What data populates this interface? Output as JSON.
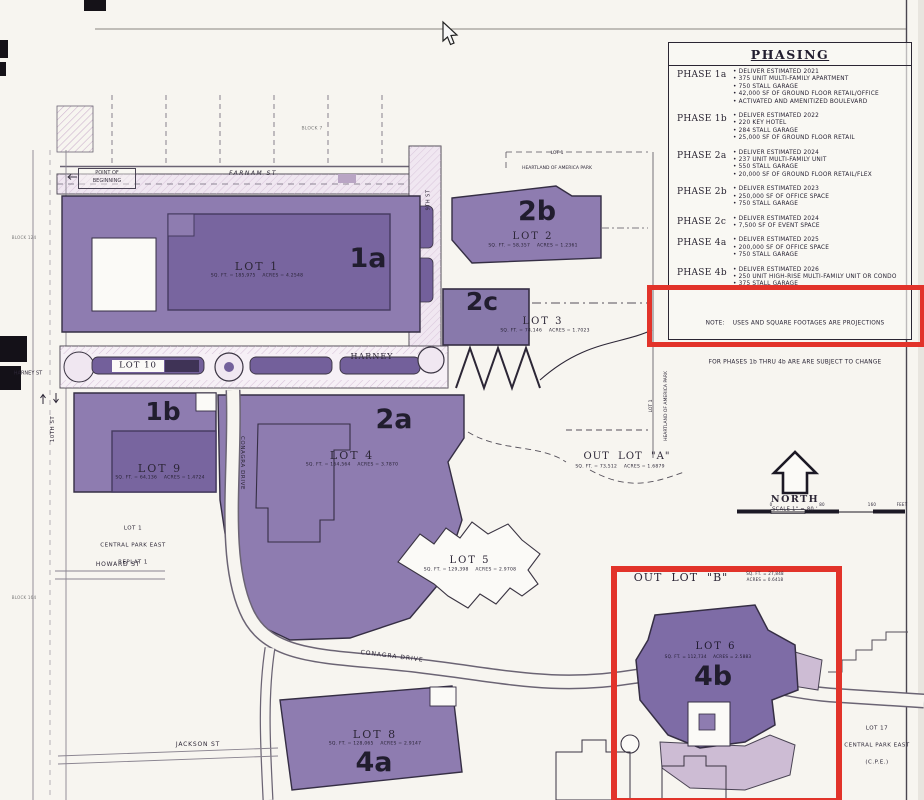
{
  "phasing": {
    "title": "PHASING",
    "rows": [
      {
        "phase": "PHASE 1a",
        "items": [
          "DELIVER ESTIMATED 2021",
          "375 UNIT MULTI-FAMILY APARTMENT",
          "750 STALL GARAGE",
          "42,000 SF OF GROUND FLOOR RETAIL/OFFICE",
          "ACTIVATED AND AMENITIZED BOULEVARD"
        ]
      },
      {
        "phase": "PHASE 1b",
        "items": [
          "DELIVER ESTIMATED 2022",
          "220 KEY HOTEL",
          "284 STALL GARAGE",
          "25,000 SF OF GROUND FLOOR RETAIL"
        ]
      },
      {
        "phase": "PHASE 2a",
        "items": [
          "DELIVER ESTIMATED 2024",
          "237 UNIT MULTI-FAMILY UNIT",
          "550 STALL GARAGE",
          "20,000 SF OF GROUND FLOOR RETAIL/FLEX"
        ]
      },
      {
        "phase": "PHASE 2b",
        "items": [
          "DELIVER ESTIMATED 2023",
          "250,000 SF OF OFFICE SPACE",
          "750 STALL GARAGE"
        ]
      },
      {
        "phase": "PHASE 2c",
        "items": [
          "DELIVER ESTIMATED 2024",
          "7,500 SF OF EVENT SPACE"
        ]
      },
      {
        "phase": "PHASE 4a",
        "items": [
          "DELIVER ESTIMATED 2025",
          "200,000 SF OF OFFICE SPACE",
          "750 STALL GARAGE"
        ]
      },
      {
        "phase": "PHASE 4b",
        "items": [
          "DELIVER ESTIMATED 2026",
          "250 UNIT HIGH-RISE MULTI-FAMILY UNIT OR CONDO",
          "375 STALL GARAGE"
        ]
      }
    ],
    "note_line1": "NOTE:    USES AND SQUARE FOOTAGES ARE PROJECTIONS",
    "note_line2": "FOR PHASES 1b THRU 4b ARE ARE SUBJECT TO CHANGE"
  },
  "compass": {
    "north": "NORTH",
    "scale": "SCALE 1\" = 80 '",
    "bar_labels": {
      "b0": "0",
      "b80": "80",
      "b160": "160",
      "bfeet": "FEET"
    }
  },
  "lots": {
    "lot1": {
      "name": "LOT 1",
      "stats": "SQ. FT. = 185,975    ACRES = 4.2548",
      "phase": "1a"
    },
    "lot2": {
      "name": "LOT 2",
      "stats": "SQ. FT. = 58,357    ACRES = 1.2361",
      "phase": "2b"
    },
    "lot3": {
      "name": "LOT 3",
      "stats": "SQ. FT. = 74,146    ACRES = 1.7023",
      "phase": "2c"
    },
    "lot4": {
      "name": "LOT 4",
      "stats": "SQ. FT. = 164,564    ACRES = 3.7870",
      "phase": "2a"
    },
    "lot5": {
      "name": "LOT 5",
      "stats": "SQ. FT. = 129,398    ACRES = 2.9708"
    },
    "lot6": {
      "name": "LOT 6",
      "stats": "SQ. FT. = 112,734    ACRES = 2.5883",
      "phase": "4b"
    },
    "lot8": {
      "name": "LOT 8",
      "stats": "SQ. FT. = 128,065    ACRES = 2.9147",
      "phase": "4a"
    },
    "lot9": {
      "name": "LOT 9",
      "stats": "SQ. FT. = 64,136    ACRES = 1.4724",
      "phase": "1b"
    },
    "lot10": {
      "name": "LOT 10"
    },
    "outlot_a": {
      "name": "OUT  LOT  \"A\"",
      "stats": "SQ. FT. = 73,512    ACRES = 1.6879"
    },
    "outlot_b": {
      "name": "OUT  LOT  \"B\"",
      "stats_line1": "SQ. FT. = 27,848",
      "stats_line2": "ACRES = 0.6418"
    }
  },
  "streets": {
    "farnam": "FARNAM ST",
    "harney": "HARNEY",
    "harney_left": "HARNEY ST",
    "howard": "HOWARD ST",
    "jackson": "JACKSON ST",
    "conagra_curve": "CONAGRA DRIVE",
    "conagra_vert": "CONAGRA DRIVE",
    "tenth": "10TH ST",
    "ninth": "9TH ST"
  },
  "annotations": {
    "pob_line1": "POINT OF",
    "pob_line2": "BEGINNING",
    "block7": "BLOCK 7",
    "block124": "BLOCK 124",
    "block164": "BLOCK 164",
    "hoap_lot": "LOT 1",
    "hoap_park": "HEARTLAND OF AMERICA PARK",
    "cpe_lot": "LOT 1",
    "cpe_name": "CENTRAL PARK EAST",
    "cpe_replat": "REPLAT 1",
    "lot17_lot": "LOT 17",
    "lot17_name": "CENTRAL PARK EAST",
    "lot17_abbr": "(C.P.E.)"
  },
  "colors": {
    "lot_purple": "#8e7cb0",
    "building_purple": "#78659f",
    "highlight_red": "#e2332a",
    "road_light": "#f0e7f1"
  }
}
